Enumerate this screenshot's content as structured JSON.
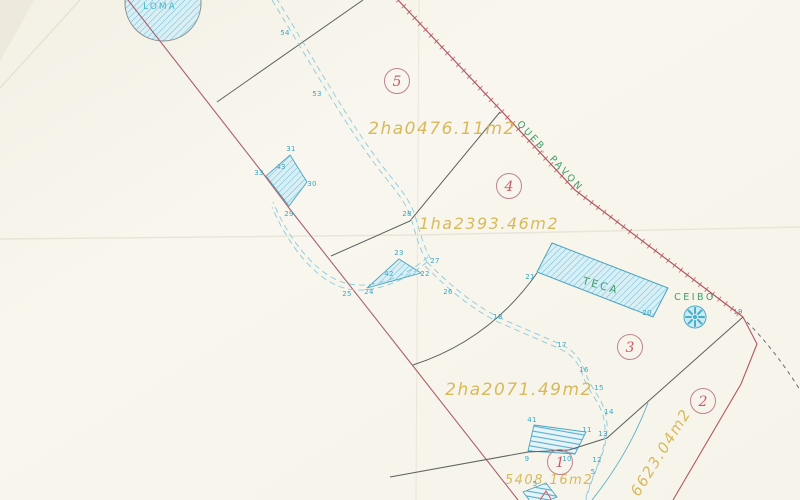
{
  "map": {
    "type": "scanned cadastral survey plan",
    "parcels": [
      {
        "number": "5",
        "area": "2ha0476.11m2"
      },
      {
        "number": "4",
        "area": "1ha2393.46m2"
      },
      {
        "number": "3",
        "area": "2ha2071.49m2"
      },
      {
        "number": "2",
        "area": "6623.04m2"
      },
      {
        "number": "1",
        "area": "5408.16m2"
      }
    ],
    "features": {
      "loma": "LOMA",
      "teca": "TECA",
      "ceibo": "CEIBO",
      "quebrada": "QUEB. PAVON"
    },
    "points": {
      "p54": "54",
      "p53": "53",
      "p31": "31",
      "p43": "43",
      "p33": "33",
      "p30": "30",
      "p29": "29",
      "p28": "28",
      "p27": "27",
      "p26": "26",
      "p25": "25",
      "p24": "24",
      "p23": "23",
      "p22": "22",
      "p42": "42",
      "p21": "21",
      "p20": "20",
      "p19": "19",
      "p18": "18",
      "p17": "17",
      "p16": "16",
      "p15": "15",
      "p14": "14",
      "p13": "13",
      "p12": "12",
      "p11": "11",
      "p10": "10",
      "p9": "9",
      "p41": "41",
      "p5a": "5",
      "p5b": "5"
    },
    "colors": {
      "paper": "#f7f5ed",
      "west_boundary": "#a86070",
      "quebrada": "#b25762",
      "pencil": "#5d615e",
      "cyan_label": "#36a9c6",
      "road": "#8ccadc",
      "hatch_fill": "#d9eff5",
      "hatch_line": "#6fc2d6",
      "green": "#3f9d67",
      "area_text": "#d6b54e",
      "parcel_number": "#ca5a68"
    }
  }
}
